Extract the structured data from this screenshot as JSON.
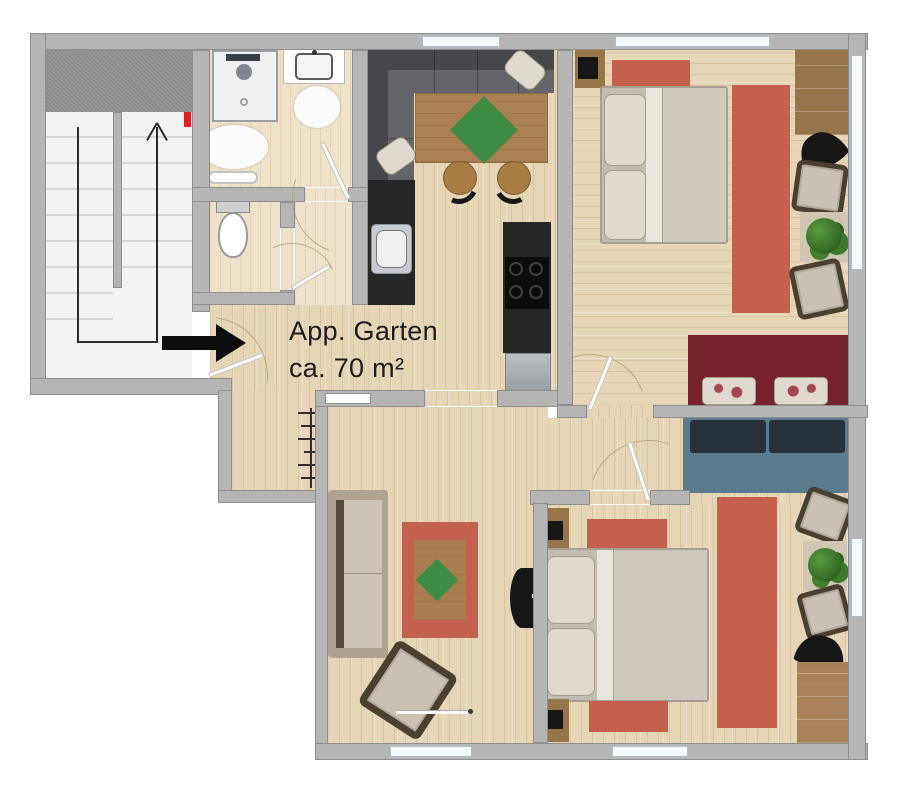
{
  "labels": {
    "apartment_name": "App. Garten",
    "area_text": "ca. 70 m²"
  },
  "icons": {
    "entrance-arrow": "solid-right-arrow",
    "stairs-direction-arrow": "up-chevron-polyline"
  },
  "rooms": [
    "stairwell",
    "bathroom",
    "wc",
    "hallway",
    "corridor",
    "kitchen-living",
    "bedroom-top",
    "living-room",
    "vestibule",
    "bedroom-bottom"
  ],
  "palette": {
    "wall": "#b5b5b5",
    "wallEdge": "#8e8e8e",
    "woodFloor": "#e6d6b7",
    "woodFloorLight": "#eee2cb",
    "stairFloor": "#f3f3f3",
    "treadLine": "#d7d7d7",
    "landing": "#8d8d8d",
    "window": "#f5fafc",
    "windowFrame": "#b3bbc1",
    "rugRed": "#c4604e",
    "rugInner": "#a87e50",
    "rugGreen": "#3f8c44",
    "sofaDark": "#46474b",
    "sofaDarkSeat": "#64656b",
    "tableWood": "#ab8052",
    "stoolWood": "#a77c45",
    "counterDark": "#262626",
    "appliance": "#a7adb1",
    "cooktop": "#0c0c0c",
    "benchMaroon": "#74202d",
    "sofaBlue": "#5d7b8e",
    "sofaBlueDark": "#27323c",
    "bedFrame": "#c3bcb1",
    "bedBlanket": "#cfc8be",
    "bedSheet": "#e9e5dd",
    "pillow": "#dfd9cf",
    "armchair": "#c9c2b3",
    "armchairDark": "#49402f",
    "deskWood": "#97754a",
    "matWood": "#a8835a",
    "matBeige": "#cfc7b2",
    "plant": "#3b7a2c",
    "black": "#161616",
    "porcelain": "#fbfbfb",
    "fixture": "#9aa0a6",
    "text": "#1c1c1c",
    "arrow": "#0d0d0d",
    "redMark": "#e02020"
  }
}
